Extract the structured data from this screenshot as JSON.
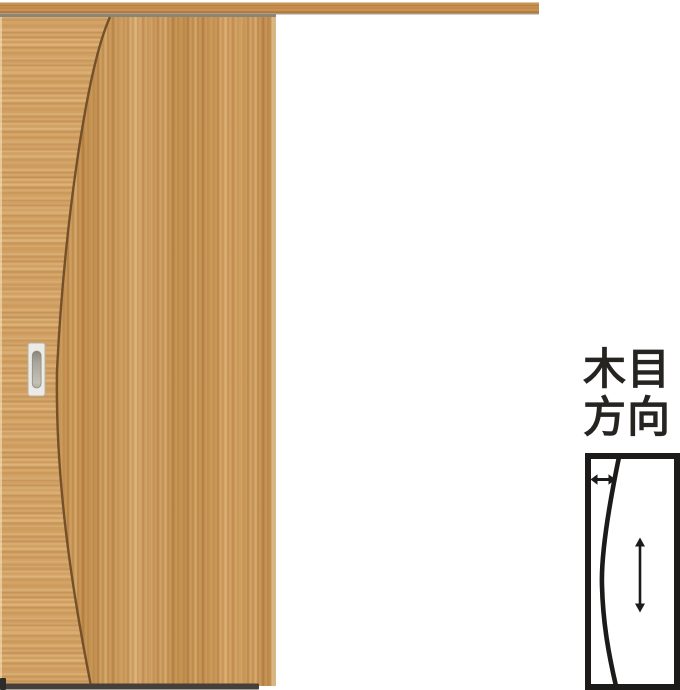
{
  "legend": {
    "line1": "木目",
    "line2": "方向"
  },
  "icons": {
    "horizontal_grain_arrow": "↔",
    "vertical_grain_arrow": "↕"
  },
  "colors": {
    "background": "#ffffff",
    "wood_base": "#c9954f",
    "wood_light": "#dfb274",
    "wood_dark": "#b97f3f",
    "grain_seam": "#6d4a26",
    "hanger_track_shadow": "#8c8577",
    "handle_plate": "#eceae4",
    "handle_recess": "#a8a59b",
    "door_bottom_shadow": "#45403a",
    "floor_guide": "#2e2c29",
    "diagram_ink": "#1c1b19",
    "label_text": "#262421"
  }
}
